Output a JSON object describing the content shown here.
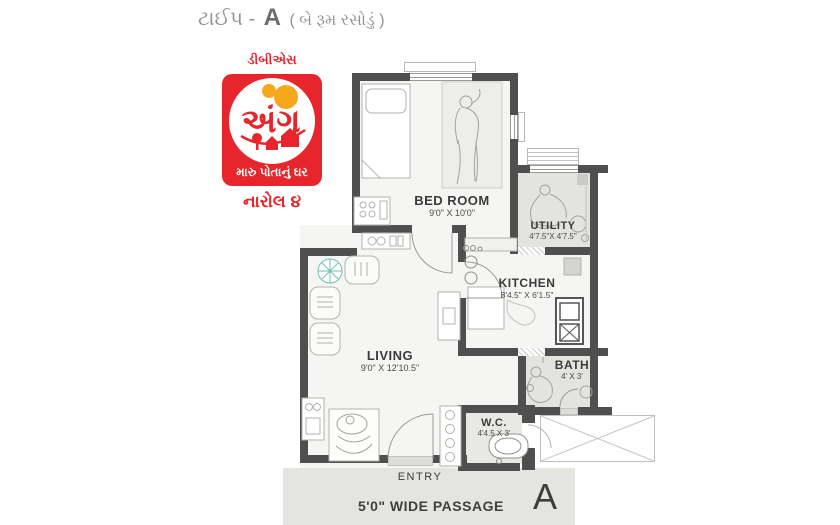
{
  "title": {
    "word_type": "ટાઈપ -",
    "letter": "A",
    "subtitle": "( બે રૂમ રસોડું )"
  },
  "logo": {
    "company": "ડીબીએસ",
    "brand": "અંગ",
    "tagline": "મારુ પોતાનું ઘર",
    "project": "નારોલ ૪"
  },
  "rooms": {
    "bedroom": {
      "name": "BED ROOM",
      "dims": "9'0\" X 10'0\""
    },
    "utility": {
      "name": "UTILITY",
      "dims": "4'7.5\"X 4'7.5\""
    },
    "kitchen": {
      "name": "KITCHEN",
      "dims": "8'4.5\" X 6'1.5\""
    },
    "living": {
      "name": "LIVING",
      "dims": "9'0\" X 12'10.5\""
    },
    "bath": {
      "name": "BATH",
      "dims": "4' X 3'"
    },
    "wc": {
      "name": "W.C.",
      "dims": "4'4.5 X 3'"
    }
  },
  "entry_label": "ENTRY",
  "passage": {
    "label": "5'0\" WIDE PASSAGE",
    "unit_letter": "A"
  },
  "colors": {
    "wall": "#4f4f4f",
    "logo_red": "#e6262c",
    "logo_orange": "#f6a81c",
    "fan_teal": "#62bcae",
    "floor_gray": "#e3e3e0",
    "passage_gray": "#e4e4e1"
  }
}
